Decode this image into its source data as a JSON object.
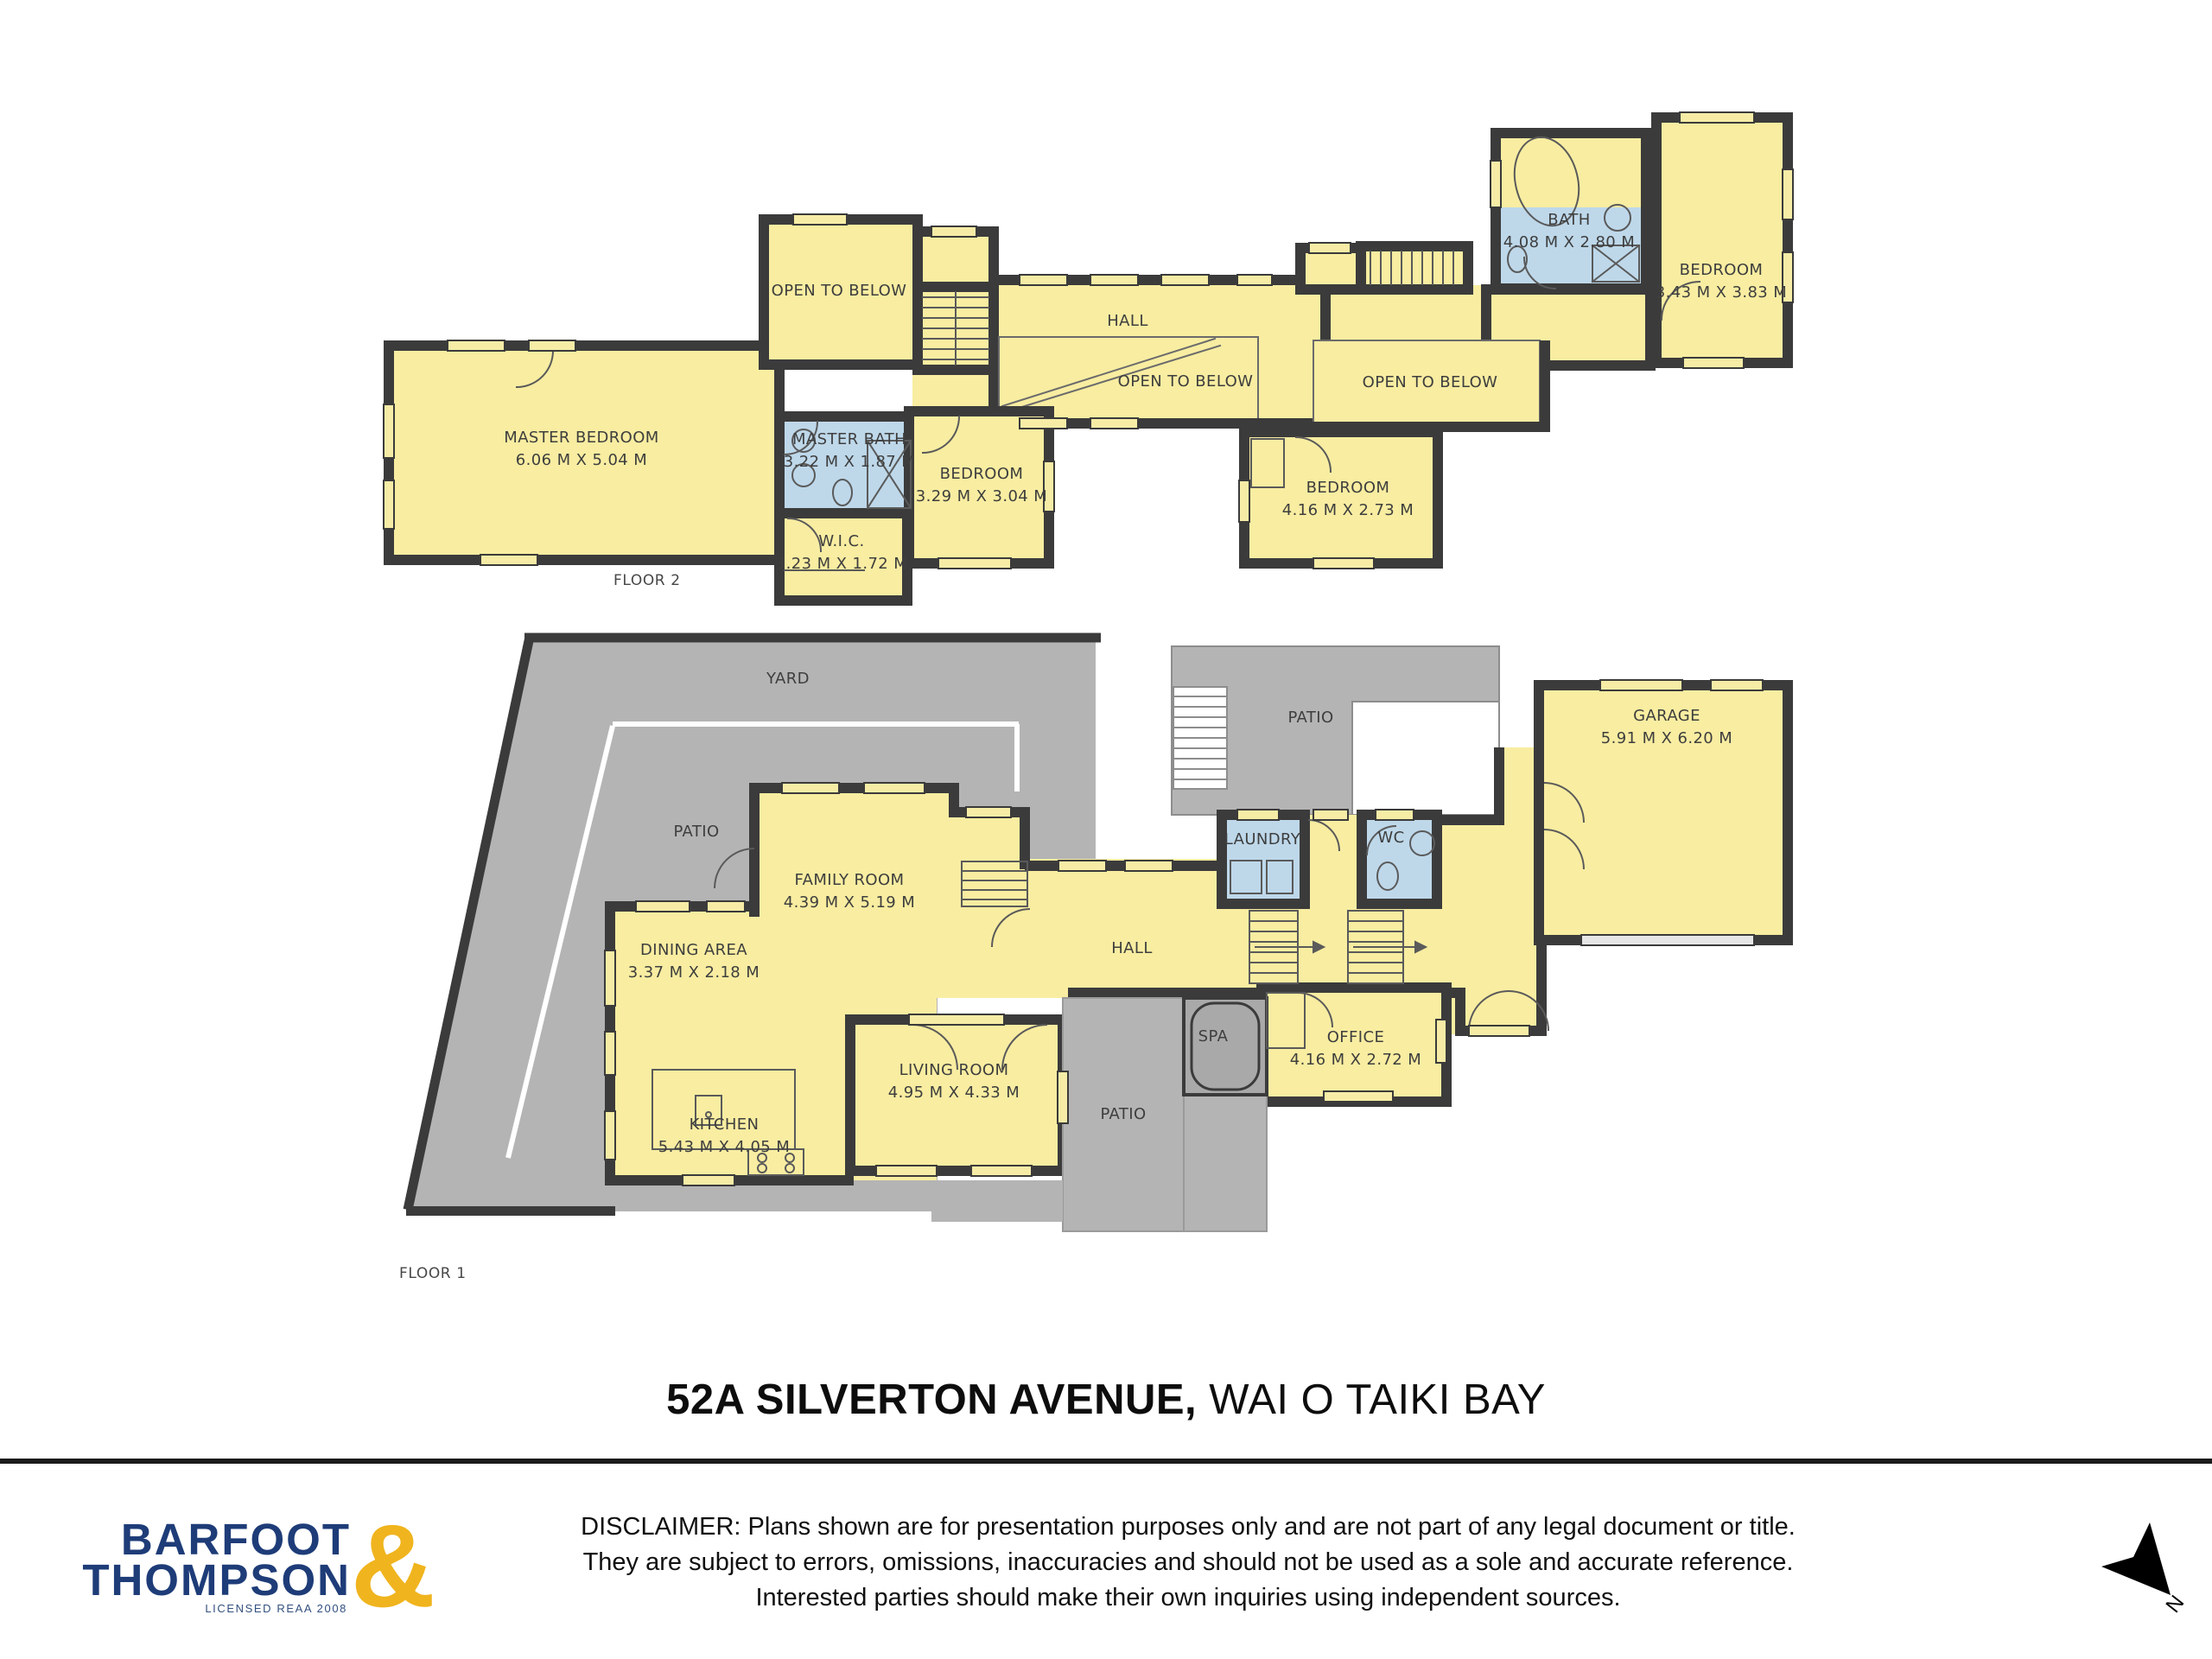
{
  "title": {
    "address_bold": "52A SILVERTON AVENUE,",
    "suburb": " WAI O TAIKI BAY"
  },
  "floor2": {
    "label": "FLOOR 2",
    "rooms": {
      "master_bedroom": {
        "name": "MASTER BEDROOM",
        "dims": "6.06 M X 5.04 M"
      },
      "master_bath": {
        "name": "MASTER BATH",
        "dims": "3.22 M X 1.87 M"
      },
      "wic": {
        "name": "W.I.C.",
        "dims": "3.23 M X 1.72 M"
      },
      "bedroom_329": {
        "name": "BEDROOM",
        "dims": "3.29 M X 3.04 M"
      },
      "bedroom_416": {
        "name": "BEDROOM",
        "dims": "4.16 M X 2.73 M"
      },
      "bath": {
        "name": "BATH",
        "dims": "4.08 M X 2.80 M"
      },
      "bedroom_343": {
        "name": "BEDROOM",
        "dims": "3.43 M X 3.83 M"
      },
      "hall": {
        "name": "HALL"
      },
      "open_to_below_1": {
        "name": "OPEN TO BELOW"
      },
      "open_to_below_2": {
        "name": "OPEN TO BELOW"
      },
      "open_to_below_3": {
        "name": "OPEN TO BELOW"
      }
    }
  },
  "floor1": {
    "label": "FLOOR 1",
    "rooms": {
      "yard": {
        "name": "YARD"
      },
      "patio_left": {
        "name": "PATIO"
      },
      "patio_top": {
        "name": "PATIO"
      },
      "patio_bottom": {
        "name": "PATIO"
      },
      "garage": {
        "name": "GARAGE",
        "dims": "5.91 M X 6.20 M"
      },
      "family_room": {
        "name": "FAMILY ROOM",
        "dims": "4.39 M X 5.19 M"
      },
      "dining_area": {
        "name": "DINING AREA",
        "dims": "3.37 M X 2.18 M"
      },
      "kitchen": {
        "name": "KITCHEN",
        "dims": "5.43 M X 4.05 M"
      },
      "living_room": {
        "name": "LIVING ROOM",
        "dims": "4.95 M X 4.33 M"
      },
      "hall": {
        "name": "HALL"
      },
      "laundry": {
        "name": "LAUNDRY"
      },
      "wc": {
        "name": "WC"
      },
      "spa": {
        "name": "SPA"
      },
      "office": {
        "name": "OFFICE",
        "dims": "4.16 M X 2.72 M"
      }
    }
  },
  "footer": {
    "disclaimer_line1": "DISCLAIMER: Plans shown are for presentation purposes only and are not part of any legal document or title.",
    "disclaimer_line2": "They are subject to errors, omissions, inaccuracies and should not be used as a sole and accurate reference.",
    "disclaimer_line3": "Interested parties should make their own inquiries using independent sources.",
    "logo": {
      "line1": "BARFOOT",
      "line2": "THOMPSON",
      "ampersand": "&",
      "license": "LICENSED REAA 2008"
    },
    "north_label": "N"
  },
  "colors": {
    "room_fill": "#f8eda1",
    "wet_fill": "#bed8ea",
    "wall": "#3b3b3b",
    "outdoor": "#b4b4b4",
    "spa_fill": "#a9a9a9",
    "logo_navy": "#1e3c78",
    "logo_gold": "#f0b41e"
  }
}
